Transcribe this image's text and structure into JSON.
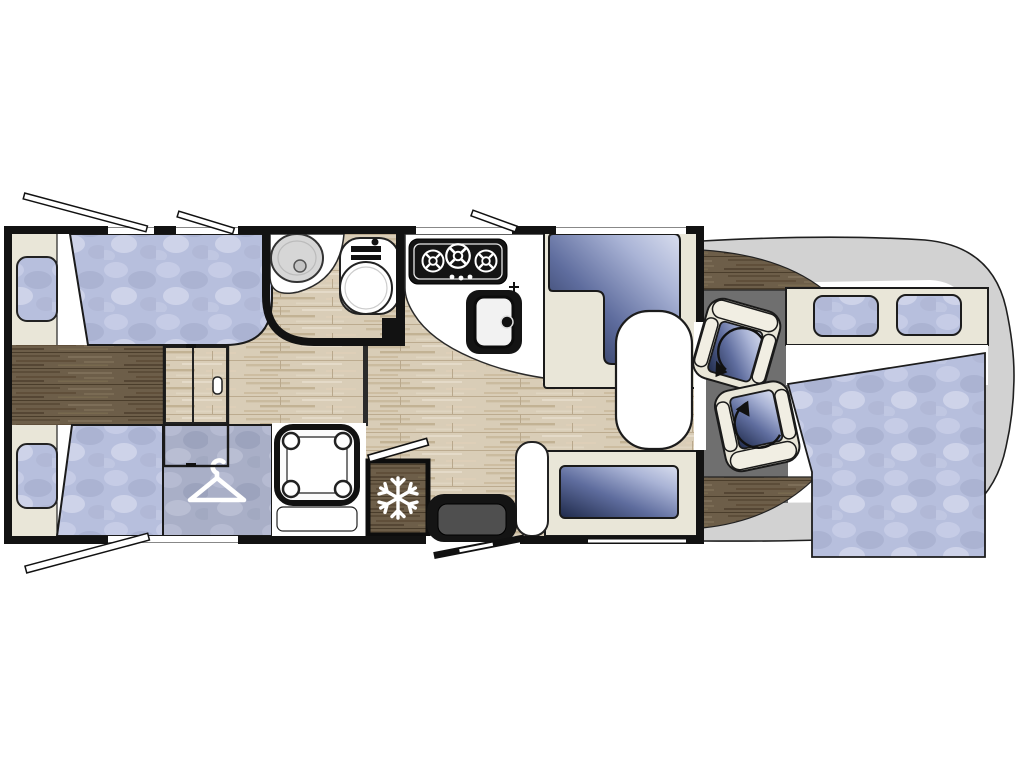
{
  "title": "Motorhome floor plan (top-down view)",
  "diagram": {
    "type": "floorplan",
    "vehicle": "motorhome",
    "orientation": "cab / driving seats at right, rear bedroom at left",
    "areas": [
      {
        "name": "rear-bedroom",
        "features": [
          "twin-bed-top",
          "twin-bed-bottom",
          "pillow-top",
          "pillow-bottom",
          "wardrobe-with-hanger",
          "dark-wood-walkway",
          "sliding-partition-door"
        ]
      },
      {
        "name": "washroom",
        "features": [
          "oval-washbasin",
          "toilet",
          "curved-partition-wall"
        ]
      },
      {
        "name": "shower-room",
        "features": [
          "shower-tray-with-four-corner-caps",
          "bench-ledge"
        ]
      },
      {
        "name": "kitchen",
        "features": [
          "three-burner-hob",
          "kitchen-sink-with-tap",
          "curved-worktop",
          "fridge-with-snowflake"
        ]
      },
      {
        "name": "dinette",
        "features": [
          "l-shaped-sofa",
          "oval-table",
          "side-bench",
          "entry-step",
          "entry-door"
        ]
      },
      {
        "name": "cab",
        "features": [
          "driver-swivel-seat",
          "passenger-swivel-seat",
          "dashboard-wood-arcs",
          "swivel-arrows"
        ]
      },
      {
        "name": "front-overcab",
        "features": [
          "drop-down-bed-mattress",
          "headboard-panel",
          "cab-window-left",
          "cab-window-right",
          "rounded-nose-body"
        ]
      }
    ],
    "counts": {
      "beds": 3,
      "cab_seats": 2,
      "hob_burners": 3,
      "headboard_windows": 2,
      "window_opening_indicators": 5,
      "pillows": 2
    },
    "icons": [
      "hanger-icon",
      "snowflake-icon",
      "swivel-arrow-icon",
      "burner-icon",
      "tap-cross-icon"
    ]
  },
  "colors": {
    "wall_black": "#121212",
    "cream": "#e9e6d8",
    "cream_light": "#f1eee3",
    "wood_light": "#d9cdb7",
    "wood_dark": "#6d5e49",
    "fabric_blue": "#b7bfdd",
    "fabric_gray": "#a9afc7",
    "cushion_dark": "#1e2949",
    "cushion_light": "#d9deef",
    "window_blue": "#b9c3e0",
    "cab_floor_gray": "#6f6f6f",
    "nose_gray": "#d2d2d2",
    "appliance_black": "#141414",
    "basin_gray": "#d6d6d6",
    "paper_white": "#ffffff"
  }
}
